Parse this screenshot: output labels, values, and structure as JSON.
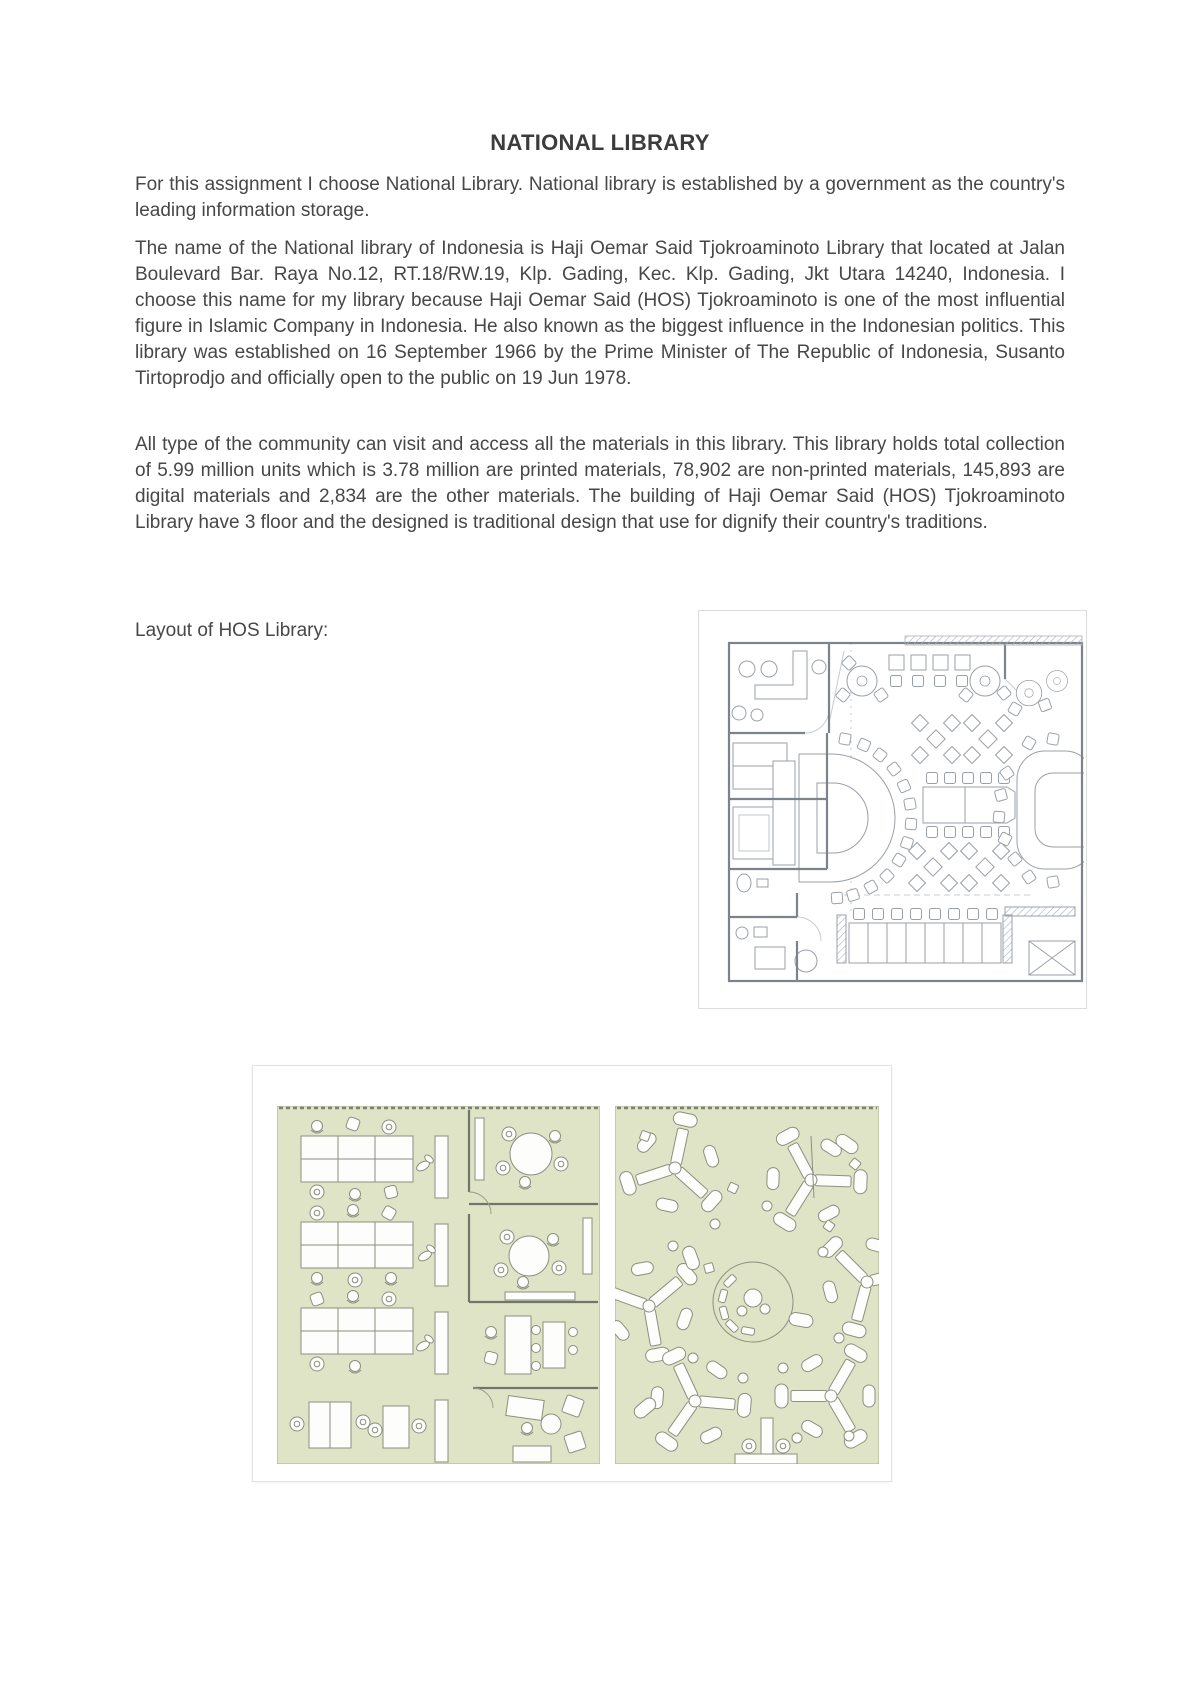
{
  "document": {
    "title": "NATIONAL LIBRARY",
    "paragraphs": [
      "For this assignment I choose National Library. National library is established by a government as the country's leading information storage.",
      "The name of the National library of Indonesia is Haji Oemar Said Tjokroaminoto Library that located at Jalan Boulevard Bar. Raya No.12, RT.18/RW.19, Klp. Gading, Kec. Klp. Gading, Jkt Utara 14240, Indonesia. I choose this name for my library because Haji Oemar Said (HOS) Tjokroaminoto is one of the most influential figure in Islamic Company in Indonesia. He also known as the biggest influence in the Indonesian politics. This library was established on 16 September 1966 by the Prime Minister of The Republic of Indonesia, Susanto Tirtoprodjo and officially open to the public on 19 Jun 1978.",
      "All type of the community can visit and access all the materials in this library. This library holds total collection of 5.99 million units which is 3.78 million are printed materials, 78,902 are non-printed materials, 145,893 are digital materials and 2,834 are the other materials. The building of Haji Oemar Said (HOS) Tjokroaminoto Library have 3 floor and the designed is traditional design that use for dignify their country's traditions."
    ],
    "layout_caption": "Layout of HOS Library:"
  },
  "figures": {
    "plan1": {
      "name": "hos-library-floor-plan-gray"
    },
    "plan2": {
      "name": "hos-library-floor-plans-green"
    }
  },
  "colors": {
    "page_bg": "#ffffff",
    "text": "#474747",
    "plan1_line": "#9aa0a8",
    "plan1_wall": "#7d838b",
    "plan2_bg": "#dfe4c6",
    "plan2_line": "#8a9080",
    "plan2_wall": "#70766a",
    "figure_border": "#dcdcdc"
  }
}
